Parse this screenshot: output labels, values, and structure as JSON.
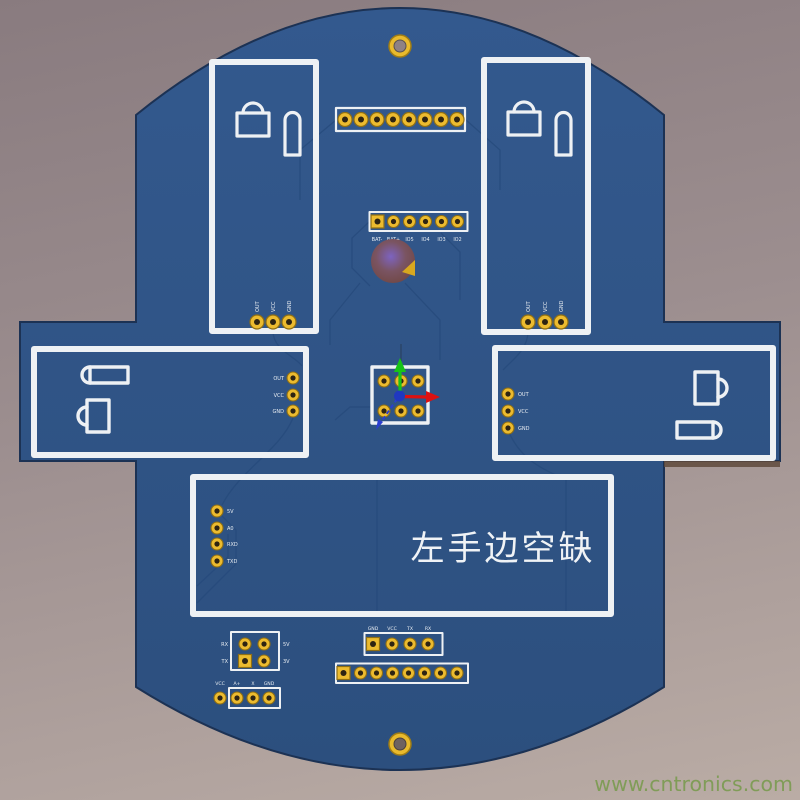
{
  "watermark": "www.cntronics.com",
  "board_note": "左手边空缺",
  "colors": {
    "background_top": "#897b7f",
    "background_bottom": "#baaca5",
    "board_blue": "#2f5586",
    "silkscreen_white": "#eef1f4",
    "pad_gold": "#ecbb2f",
    "pad_hole": "#2e2412",
    "axis_x_red": "#dd1111",
    "axis_y_green": "#17c417",
    "axis_z_blue": "#2b3ed0",
    "watermark_green": "#7e9c54"
  },
  "modules": {
    "top_header": {
      "pins": "8"
    },
    "battery_header": {
      "pins": "6",
      "labels": [
        "BAT-",
        "BAT+",
        "IO5",
        "IO4",
        "IO3",
        "IO2"
      ]
    },
    "left_ultrasonic": {
      "labels": [
        "OUT",
        "VCC",
        "GND"
      ]
    },
    "right_ultrasonic": {
      "labels": [
        "OUT",
        "VCC",
        "GND"
      ]
    },
    "left_side_module": {
      "labels": [
        "OUT",
        "VCC",
        "GND"
      ]
    },
    "right_side_module": {
      "labels": [
        "OUT",
        "VCC",
        "GND"
      ]
    },
    "bottom_module": {
      "labels": [
        "5V",
        "A0",
        "RXD",
        "TXD"
      ]
    },
    "center_block": {
      "pins": "6"
    },
    "quad_header": {
      "left_labels": [
        "RX",
        "TX"
      ],
      "right_labels": [
        "5V",
        "3V"
      ]
    },
    "serial_header": {
      "labels": [
        "GND",
        "VCC",
        "TX",
        "RX"
      ]
    },
    "aux_header": {
      "labels": [
        "VCC",
        "A+",
        "X",
        "GND"
      ]
    },
    "bottom_header": {
      "pins": "8"
    }
  }
}
